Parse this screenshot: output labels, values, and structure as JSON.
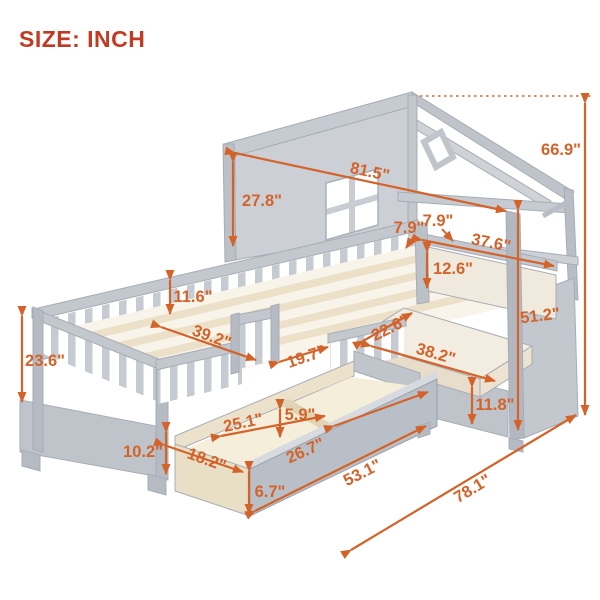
{
  "title": "SIZE: INCH",
  "unit": "INCH",
  "colors": {
    "dimension_accent": "#d4632a",
    "title_red": "#c13a24",
    "furniture_gray": "#c6cad1",
    "furniture_gray_dark": "#b6bbc3",
    "wood_cream": "#f2ead9",
    "background": "#ffffff"
  },
  "dimensions": {
    "roof_length": "81.5\"",
    "wall_height": "27.8\"",
    "total_height": "66.9\"",
    "top_rail_a": "7.9\"",
    "top_rail_b": "7.9\"",
    "backrest_width": "37.6\"",
    "backrest_height": "12.6\"",
    "guardrail_height": "11.6\"",
    "bed_width": "39.2\"",
    "headboard_height": "23.6\"",
    "entrance_width": "19.7\"",
    "seat_depth": "22.6\"",
    "seat_width": "38.2\"",
    "bench_height": "51.2\"",
    "bench_base_height": "11.8\"",
    "bed_base_height": "10.2\"",
    "drawer_left_section": "25.1\"",
    "drawer_divider_height": "5.9\"",
    "drawer_right_section": "26.7\"",
    "drawer_depth": "18.2\"",
    "drawer_front_height": "6.7\"",
    "drawer_length": "53.1\"",
    "total_length": "78.1\""
  }
}
